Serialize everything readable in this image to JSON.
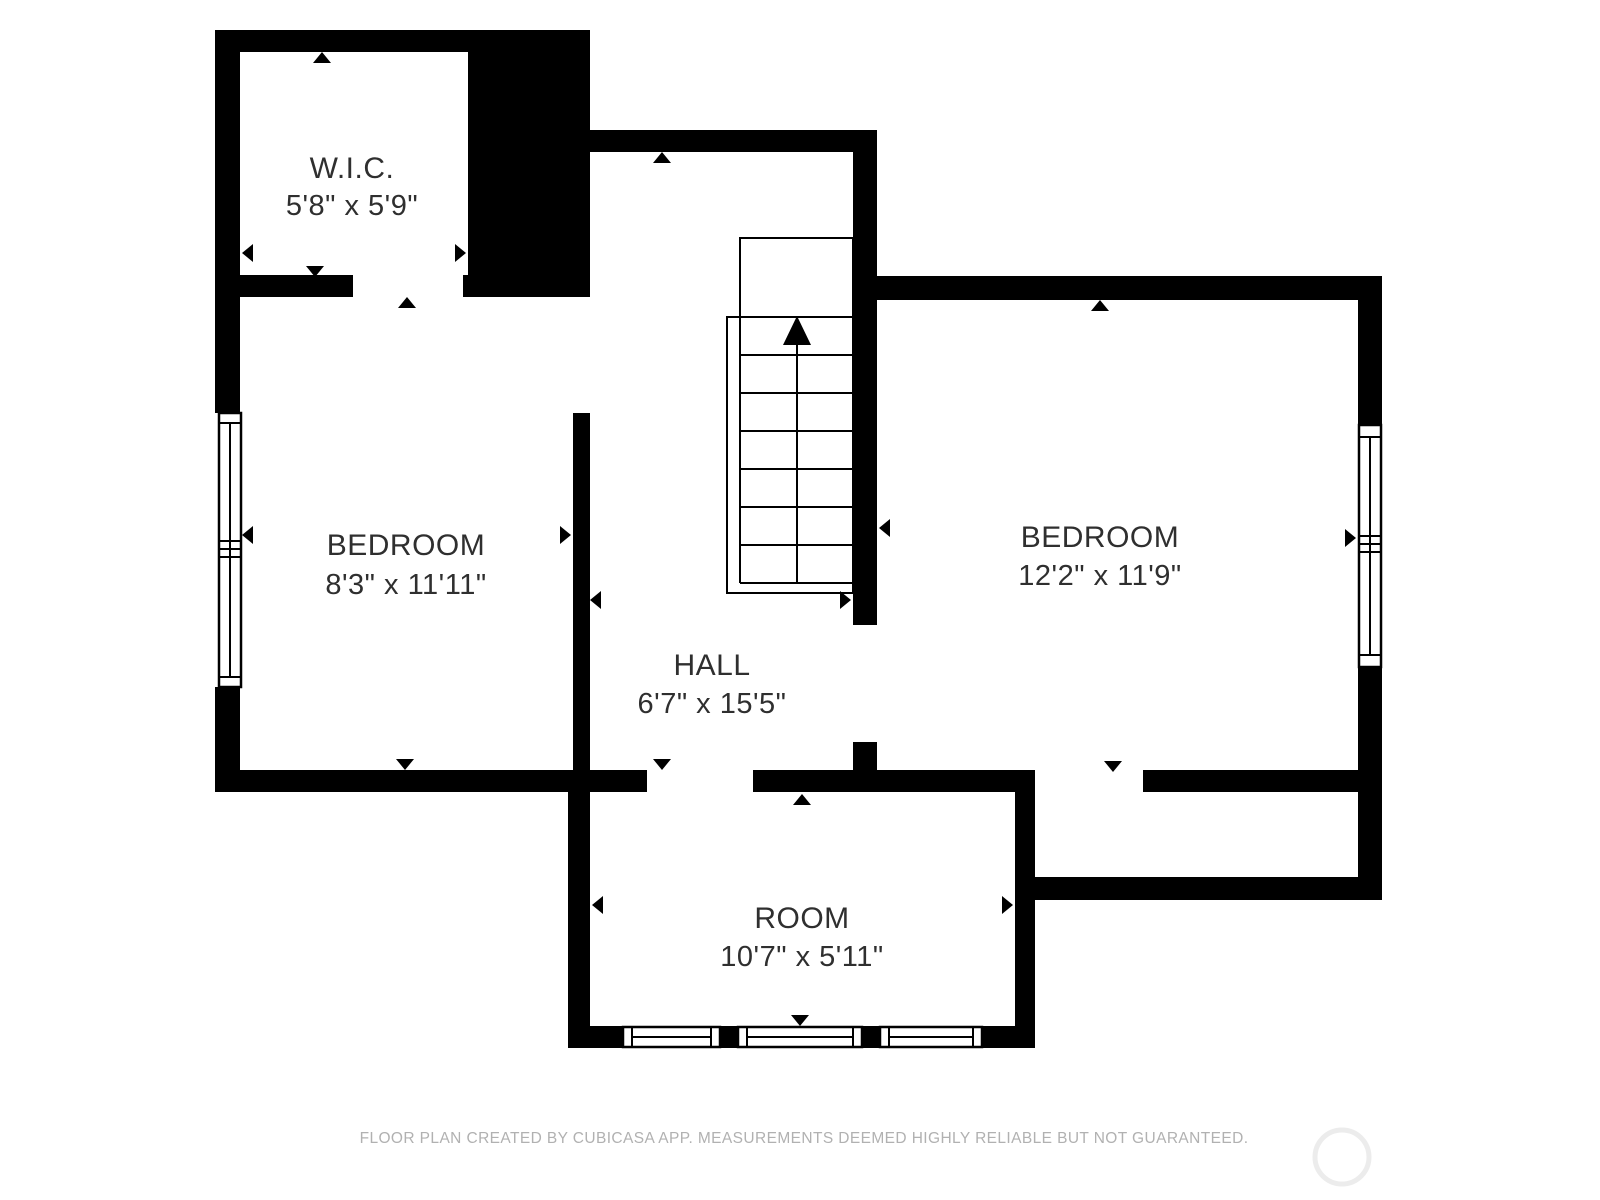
{
  "page": {
    "type": "floor-plan",
    "background": "#ffffff"
  },
  "rooms": [
    {
      "id": "wic",
      "name": "W.I.C.",
      "dimensions": "5'8\" x 5'9\""
    },
    {
      "id": "bedroom-left",
      "name": "BEDROOM",
      "dimensions": "8'3\" x 11'11\""
    },
    {
      "id": "hall",
      "name": "HALL",
      "dimensions": "6'7\" x 15'5\""
    },
    {
      "id": "bedroom-right",
      "name": "BEDROOM",
      "dimensions": "12'2\" x 11'9\""
    },
    {
      "id": "room",
      "name": "ROOM",
      "dimensions": "10'7\" x 5'11\""
    }
  ],
  "stairs": {
    "direction": "up",
    "treads": 7
  },
  "windows": {
    "left_wall": 1,
    "right_wall": 1,
    "bottom_wall": 3
  },
  "footer": {
    "disclaimer": "FLOOR PLAN CREATED BY CUBICASA APP. MEASUREMENTS DEEMED HIGHLY RELIABLE BUT NOT GUARANTEED."
  },
  "colors": {
    "wall": "#000000",
    "label": "#2f2f2f",
    "footer_text": "#b1b1b1",
    "watermark": "#ececec",
    "background": "#ffffff"
  }
}
